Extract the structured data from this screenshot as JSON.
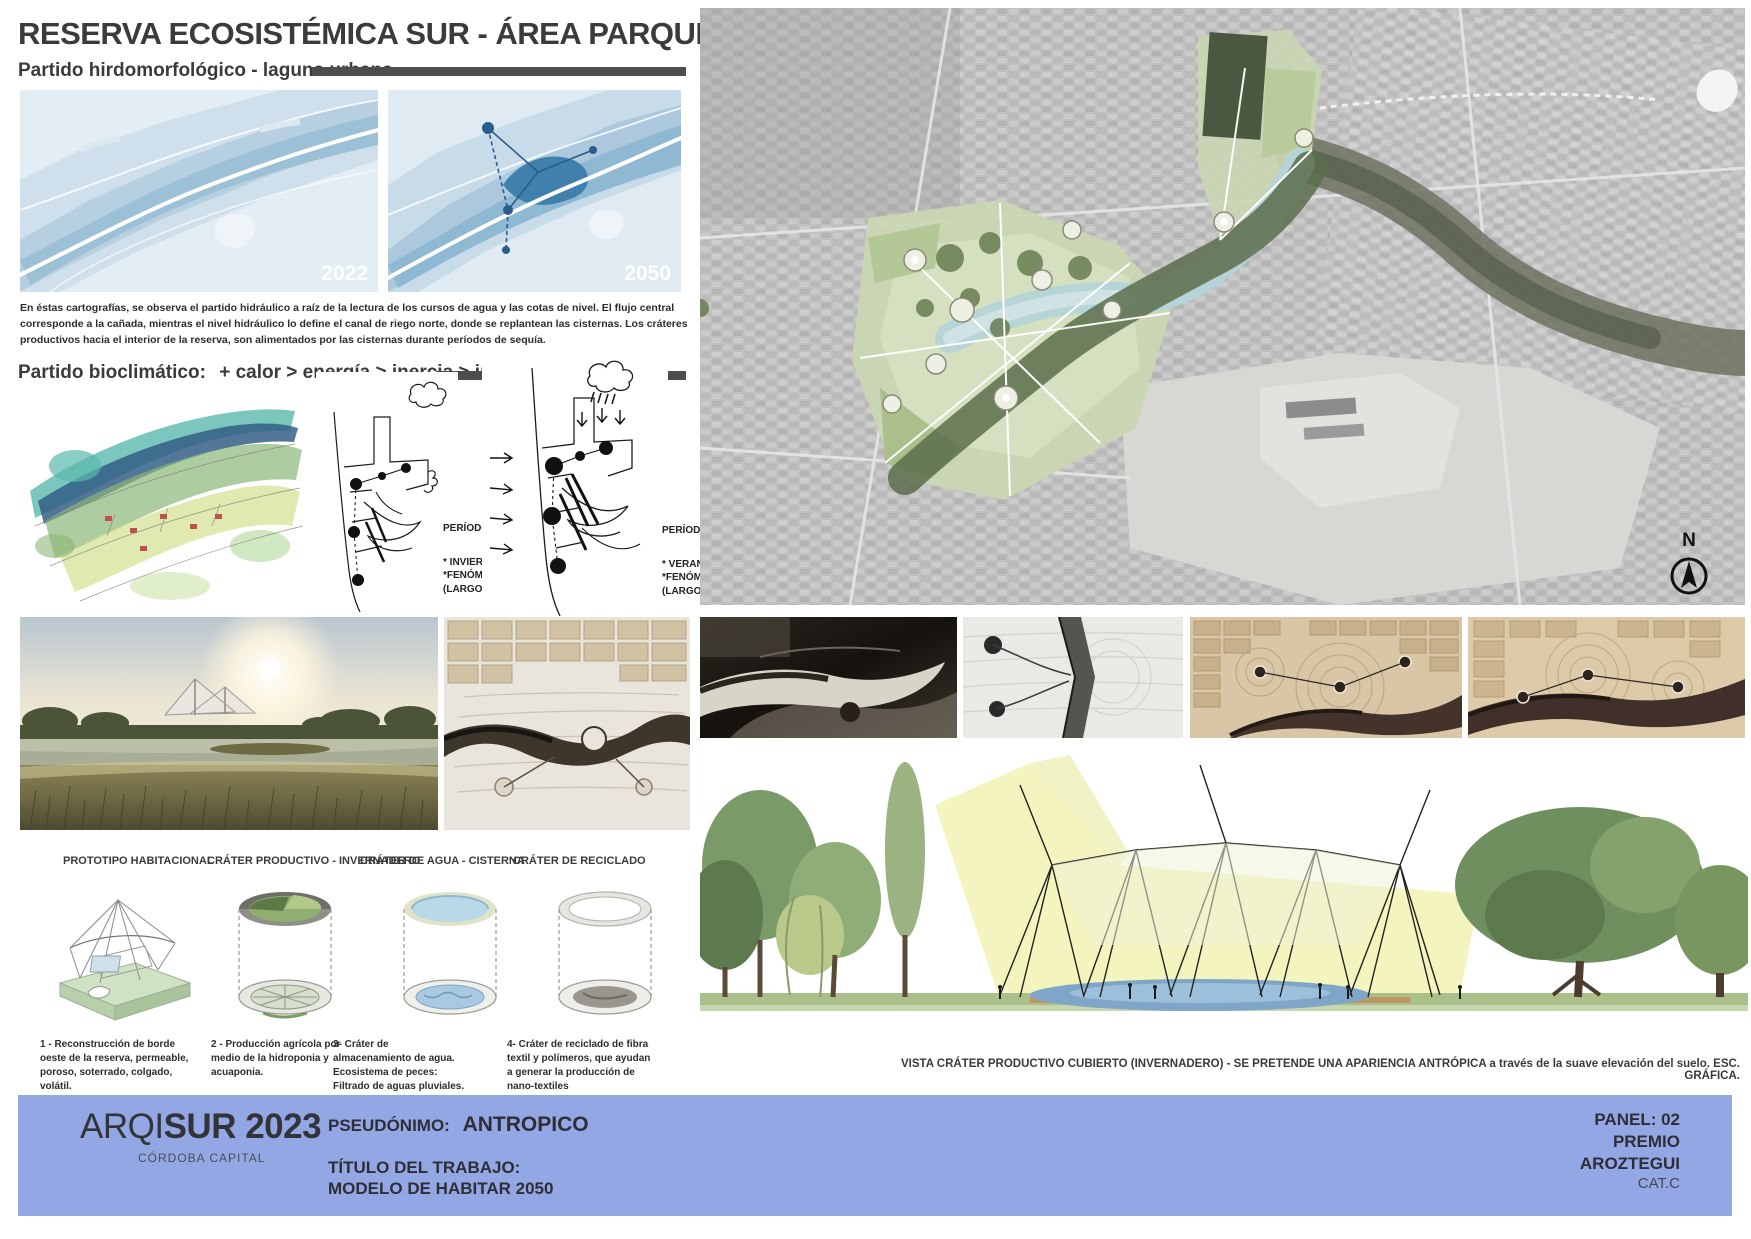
{
  "panel": {
    "title": "RESERVA ECOSISTÉMICA SUR - ÁREA PARQUE DE LA VIDA",
    "hydro_section": {
      "heading": "Partido hirdomorfológico - laguna urbana",
      "maps": [
        {
          "year_label": "2022"
        },
        {
          "year_label": "2050"
        }
      ],
      "paragraph": "En éstas cartografías, se observa el partido hidráulico a raíz de la lectura de los cursos de agua y las cotas de nivel. El flujo central corresponde a la cañada, mientras el nivel hidráulico lo define el canal de riego norte, donde se replantean las cisternas.  Los cráteres productivos hacia el interior de la reserva, son alimentados por las cisternas durante períodos de sequía."
    },
    "bioclim_section": {
      "heading": "Partido bioclimático:",
      "formula": "+ calor  > energía > inercia > intensidad*",
      "asterisk_left": "(*)",
      "asterisk_right": "(*)",
      "dry_period": {
        "title": "PERÍODO SECO:",
        "lines": [
          "* INVIERNO (CORTO)",
          "*FENÓMENO DE LA NIÑA",
          "(LARGO)"
        ]
      },
      "summer_period": {
        "title": "PERÍODO ESTIVAL:",
        "lines": [
          "* VERANO (CORTO)",
          "*FENÓMENO DEL NIÑO",
          "(LARGO)"
        ]
      }
    },
    "aerial": {
      "north_label": "N"
    },
    "prototypes": {
      "items": [
        {
          "label": "PROTOTIPO HABITACIONAL",
          "description": "1 - Reconstrucción de borde oeste de la reserva, permeable, poroso, soterrado, colgado, volátil."
        },
        {
          "label": "CRÁTER PRODUCTIVO - INVERNADERO",
          "description": "2 - Producción agrícola por medio de la hidroponia y acuaponia."
        },
        {
          "label": "CRÁTER DE AGUA - CISTERNA",
          "description": "3- Cráter de almacenamiento de agua. Ecosistema de peces: Filtrado de aguas pluviales."
        },
        {
          "label": "CRÁTER DE RECICLADO",
          "description": "4- Cráter de reciclado de fibra textil y polímeros, que ayudan a generar la producción de nano-textiles"
        }
      ]
    },
    "section_view_caption": "VISTA CRÁTER PRODUCTIVO CUBIERTO (INVERNADERO) - SE PRETENDE UNA APARIENCIA ANTRÓPICA a través de la suave elevación del suelo. ESC. GRÁFICA.",
    "footer": {
      "logo_light": "ARQI",
      "logo_bold": "SUR 2023",
      "logo_sub": "CÓRDOBA CAPITAL",
      "pseudonym_label": "PSEUDÓNIMO:",
      "pseudonym_value": "ANTROPICO",
      "work_title_label": "TÍTULO DEL TRABAJO:",
      "work_title_value": "MODELO DE HABITAR 2050",
      "panel_number": "PANEL: 02",
      "award_line1": "PREMIO",
      "award_line2": "AROZTEGUI",
      "category": "CAT.C",
      "bg_color": "#92a7e4"
    },
    "colors": {
      "heading_text": "#3b3b3b",
      "divider_bar": "#4d4d4d",
      "map_base": "#e3edf4",
      "map_deep": "#4080ad",
      "footer_blue": "#92a7e4"
    }
  }
}
